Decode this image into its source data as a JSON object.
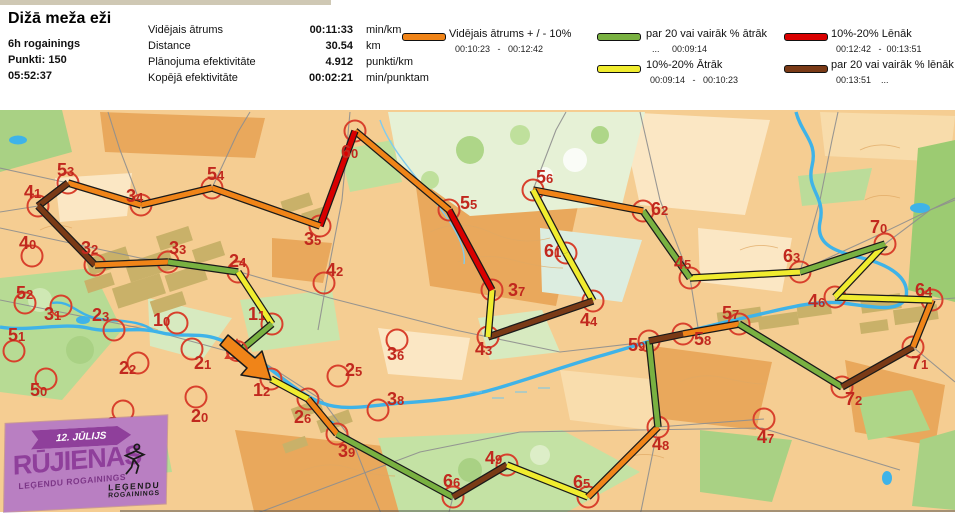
{
  "header": {
    "title": "Dižā meža eži",
    "event": "6h rogainings",
    "points": "Punkti: 150",
    "total_time": "05:52:37",
    "stats": [
      {
        "label": "Vidējais ātrums",
        "value": "00:11:33",
        "unit": "min/km"
      },
      {
        "label": "Distance",
        "value": "30.54",
        "unit": "km"
      },
      {
        "label": "Plānojuma efektivitāte",
        "value": "4.912",
        "unit": "punkti/km"
      },
      {
        "label": "Kopējā efektivitāte",
        "value": "00:02:21",
        "unit": "min/punktam"
      }
    ],
    "legend": [
      {
        "pace": "avg",
        "label": "Vidējais ātrums + / - 10%",
        "range": "00:10:23   -   00:12:42"
      },
      {
        "pace": "fast20",
        "label": "par 20 vai vairāk % ātrāk",
        "range": "...     00:09:14"
      },
      {
        "pace": "fast10",
        "label": "10%-20% Ātrāk",
        "range": "00:09:14   -   00:10:23"
      },
      {
        "pace": "slow10",
        "label": "10%-20% Lēnāk",
        "range": "00:12:42   -  00:13:51"
      },
      {
        "pace": "slow20",
        "label": "par 20 vai vairāk % lēnāk",
        "range": "00:13:51    ..."
      }
    ]
  },
  "logo": {
    "date": "12. JŪLIJS",
    "name": "RŪJIENAS",
    "sub": "LEĢENDU ROGAININGS",
    "right_line1": "LEĢENDU",
    "right_line2": "ROGAININGS"
  },
  "map": {
    "control_color": "#d8402c",
    "number_color": "#c1281e",
    "pace_colors": {
      "avg": "#f08418",
      "fast20": "#79b141",
      "fast10": "#f0ec2f",
      "slow10": "#d90000",
      "slow20": "#7a3a16"
    },
    "controls": [
      {
        "num": "53",
        "cx": 68,
        "cy": 183,
        "tx": 57,
        "ty": 164,
        "visited": true
      },
      {
        "num": "41",
        "cx": 38,
        "cy": 206,
        "tx": 24,
        "ty": 186,
        "visited": true
      },
      {
        "num": "34",
        "cx": 141,
        "cy": 205,
        "tx": 126,
        "ty": 190,
        "visited": true
      },
      {
        "num": "54",
        "cx": 212,
        "cy": 188,
        "tx": 207,
        "ty": 168,
        "visited": true
      },
      {
        "num": "35",
        "cx": 320,
        "cy": 226,
        "tx": 304,
        "ty": 233,
        "visited": true
      },
      {
        "num": "60",
        "cx": 355,
        "cy": 131,
        "tx": 341,
        "ty": 146,
        "visited": true
      },
      {
        "num": "55",
        "cx": 449,
        "cy": 210,
        "tx": 460,
        "ty": 197,
        "visited": true
      },
      {
        "num": "56",
        "cx": 533,
        "cy": 190,
        "tx": 536,
        "ty": 171,
        "visited": true
      },
      {
        "num": "61",
        "cx": 566,
        "cy": 253,
        "tx": 544,
        "ty": 245,
        "visited": true
      },
      {
        "num": "44",
        "cx": 593,
        "cy": 301,
        "tx": 580,
        "ty": 314,
        "visited": true
      },
      {
        "num": "43",
        "cx": 488,
        "cy": 337,
        "tx": 475,
        "ty": 343,
        "visited": true
      },
      {
        "num": "37",
        "cx": 492,
        "cy": 290,
        "tx": 508,
        "ty": 284,
        "visited": true
      },
      {
        "num": "62",
        "cx": 643,
        "cy": 211,
        "tx": 651,
        "ty": 203,
        "visited": true
      },
      {
        "num": "45",
        "cx": 690,
        "cy": 278,
        "tx": 674,
        "ty": 257,
        "visited": true
      },
      {
        "num": "63",
        "cx": 800,
        "cy": 272,
        "tx": 783,
        "ty": 250,
        "visited": true
      },
      {
        "num": "70",
        "cx": 885,
        "cy": 244,
        "tx": 870,
        "ty": 221,
        "visited": true
      },
      {
        "num": "46",
        "cx": 835,
        "cy": 297,
        "tx": 808,
        "ty": 295,
        "visited": true
      },
      {
        "num": "64",
        "cx": 932,
        "cy": 300,
        "tx": 915,
        "ty": 284,
        "visited": true
      },
      {
        "num": "71",
        "cx": 913,
        "cy": 347,
        "tx": 911,
        "ty": 357,
        "visited": true
      },
      {
        "num": "72",
        "cx": 842,
        "cy": 387,
        "tx": 845,
        "ty": 393,
        "visited": true
      },
      {
        "num": "57",
        "cx": 739,
        "cy": 324,
        "tx": 722,
        "ty": 307,
        "visited": true
      },
      {
        "num": "58",
        "cx": 683,
        "cy": 334,
        "tx": 694,
        "ty": 333,
        "visited": true
      },
      {
        "num": "59",
        "cx": 649,
        "cy": 341,
        "tx": 628,
        "ty": 339,
        "visited": true
      },
      {
        "num": "48",
        "cx": 658,
        "cy": 427,
        "tx": 652,
        "ty": 438,
        "visited": true
      },
      {
        "num": "65",
        "cx": 588,
        "cy": 497,
        "tx": 573,
        "ty": 476,
        "visited": true
      },
      {
        "num": "49",
        "cx": 507,
        "cy": 465,
        "tx": 485,
        "ty": 452,
        "visited": true
      },
      {
        "num": "66",
        "cx": 453,
        "cy": 497,
        "tx": 443,
        "ty": 475,
        "visited": true
      },
      {
        "num": "39",
        "cx": 337,
        "cy": 434,
        "tx": 338,
        "ty": 445,
        "visited": true
      },
      {
        "num": "26",
        "cx": 308,
        "cy": 399,
        "tx": 294,
        "ty": 411,
        "visited": true
      },
      {
        "num": "12",
        "cx": 271,
        "cy": 379,
        "tx": 253,
        "ty": 384,
        "visited": true
      },
      {
        "num": "11",
        "cx": 272,
        "cy": 324,
        "tx": 248,
        "ty": 308,
        "visited": true
      },
      {
        "num": "24",
        "cx": 238,
        "cy": 272,
        "tx": 229,
        "ty": 255,
        "visited": true
      },
      {
        "num": "33",
        "cx": 168,
        "cy": 262,
        "tx": 169,
        "ty": 242,
        "visited": true
      },
      {
        "num": "32",
        "cx": 95,
        "cy": 265,
        "tx": 81,
        "ty": 242,
        "visited": true
      },
      {
        "num": "40",
        "cx": 32,
        "cy": 256,
        "tx": 19,
        "ty": 237,
        "visited": false
      },
      {
        "num": "52",
        "cx": 25,
        "cy": 303,
        "tx": 16,
        "ty": 287,
        "visited": false
      },
      {
        "num": "51",
        "cx": 14,
        "cy": 351,
        "tx": 8,
        "ty": 329,
        "visited": false
      },
      {
        "num": "31",
        "cx": 61,
        "cy": 306,
        "tx": 44,
        "ty": 308,
        "visited": false
      },
      {
        "num": "23",
        "cx": 114,
        "cy": 330,
        "tx": 92,
        "ty": 309,
        "visited": false
      },
      {
        "num": "10",
        "cx": 177,
        "cy": 323,
        "tx": 153,
        "ty": 314,
        "visited": false
      },
      {
        "num": "22",
        "cx": 138,
        "cy": 363,
        "tx": 119,
        "ty": 362,
        "visited": false
      },
      {
        "num": "21",
        "cx": 192,
        "cy": 349,
        "tx": 194,
        "ty": 357,
        "visited": false
      },
      {
        "num": "50",
        "cx": 46,
        "cy": 379,
        "tx": 30,
        "ty": 384,
        "visited": false
      },
      {
        "num": "20",
        "cx": 196,
        "cy": 397,
        "tx": 191,
        "ty": 410,
        "visited": false
      },
      {
        "num": "30",
        "cx": 123,
        "cy": 411,
        "tx": 107,
        "ty": 418,
        "visited": false
      },
      {
        "num": "25",
        "cx": 338,
        "cy": 376,
        "tx": 345,
        "ty": 364,
        "visited": false
      },
      {
        "num": "42",
        "cx": 324,
        "cy": 283,
        "tx": 326,
        "ty": 264,
        "visited": false
      },
      {
        "num": "36",
        "cx": 397,
        "cy": 340,
        "tx": 387,
        "ty": 348,
        "visited": false
      },
      {
        "num": "38",
        "cx": 378,
        "cy": 410,
        "tx": 387,
        "ty": 393,
        "visited": false
      },
      {
        "num": "47",
        "cx": 764,
        "cy": 419,
        "tx": 757,
        "ty": 431,
        "visited": false
      }
    ],
    "route": [
      {
        "x1": 271,
        "y1": 379,
        "x2": 308,
        "y2": 399,
        "pace": "fast10"
      },
      {
        "x1": 308,
        "y1": 399,
        "x2": 337,
        "y2": 434,
        "pace": "avg"
      },
      {
        "x1": 337,
        "y1": 434,
        "x2": 453,
        "y2": 497,
        "pace": "fast20"
      },
      {
        "x1": 453,
        "y1": 497,
        "x2": 507,
        "y2": 465,
        "pace": "slow20"
      },
      {
        "x1": 507,
        "y1": 465,
        "x2": 588,
        "y2": 497,
        "pace": "fast10"
      },
      {
        "x1": 588,
        "y1": 497,
        "x2": 658,
        "y2": 427,
        "pace": "avg"
      },
      {
        "x1": 658,
        "y1": 427,
        "x2": 649,
        "y2": 341,
        "pace": "fast20"
      },
      {
        "x1": 649,
        "y1": 341,
        "x2": 683,
        "y2": 334,
        "pace": "slow20"
      },
      {
        "x1": 683,
        "y1": 334,
        "x2": 739,
        "y2": 324,
        "pace": "avg"
      },
      {
        "x1": 739,
        "y1": 324,
        "x2": 842,
        "y2": 387,
        "pace": "fast20"
      },
      {
        "x1": 842,
        "y1": 387,
        "x2": 913,
        "y2": 347,
        "pace": "slow20"
      },
      {
        "x1": 913,
        "y1": 347,
        "x2": 932,
        "y2": 300,
        "pace": "avg"
      },
      {
        "x1": 932,
        "y1": 300,
        "x2": 835,
        "y2": 297,
        "pace": "fast10"
      },
      {
        "x1": 835,
        "y1": 297,
        "x2": 885,
        "y2": 244,
        "pace": "fast10"
      },
      {
        "x1": 885,
        "y1": 244,
        "x2": 800,
        "y2": 272,
        "pace": "fast20"
      },
      {
        "x1": 800,
        "y1": 272,
        "x2": 690,
        "y2": 278,
        "pace": "fast10"
      },
      {
        "x1": 690,
        "y1": 278,
        "x2": 643,
        "y2": 211,
        "pace": "fast20"
      },
      {
        "x1": 643,
        "y1": 211,
        "x2": 533,
        "y2": 190,
        "pace": "avg"
      },
      {
        "x1": 533,
        "y1": 190,
        "x2": 566,
        "y2": 253,
        "pace": "fast10"
      },
      {
        "x1": 566,
        "y1": 253,
        "x2": 593,
        "y2": 301,
        "pace": "fast10"
      },
      {
        "x1": 593,
        "y1": 301,
        "x2": 488,
        "y2": 337,
        "pace": "slow20"
      },
      {
        "x1": 488,
        "y1": 337,
        "x2": 492,
        "y2": 290,
        "pace": "fast10"
      },
      {
        "x1": 492,
        "y1": 290,
        "x2": 449,
        "y2": 210,
        "pace": "slow10"
      },
      {
        "x1": 449,
        "y1": 210,
        "x2": 355,
        "y2": 131,
        "pace": "avg"
      },
      {
        "x1": 355,
        "y1": 131,
        "x2": 320,
        "y2": 226,
        "pace": "slow10"
      },
      {
        "x1": 320,
        "y1": 226,
        "x2": 212,
        "y2": 188,
        "pace": "avg"
      },
      {
        "x1": 212,
        "y1": 188,
        "x2": 141,
        "y2": 205,
        "pace": "avg"
      },
      {
        "x1": 141,
        "y1": 205,
        "x2": 68,
        "y2": 183,
        "pace": "avg"
      },
      {
        "x1": 68,
        "y1": 183,
        "x2": 38,
        "y2": 206,
        "pace": "slow20"
      },
      {
        "x1": 38,
        "y1": 206,
        "x2": 95,
        "y2": 265,
        "pace": "slow20"
      },
      {
        "x1": 95,
        "y1": 265,
        "x2": 168,
        "y2": 262,
        "pace": "avg"
      },
      {
        "x1": 168,
        "y1": 262,
        "x2": 238,
        "y2": 272,
        "pace": "fast20"
      },
      {
        "x1": 238,
        "y1": 272,
        "x2": 272,
        "y2": 324,
        "pace": "fast10"
      },
      {
        "x1": 272,
        "y1": 324,
        "x2": 240,
        "y2": 351,
        "pace": "fast20"
      }
    ]
  }
}
